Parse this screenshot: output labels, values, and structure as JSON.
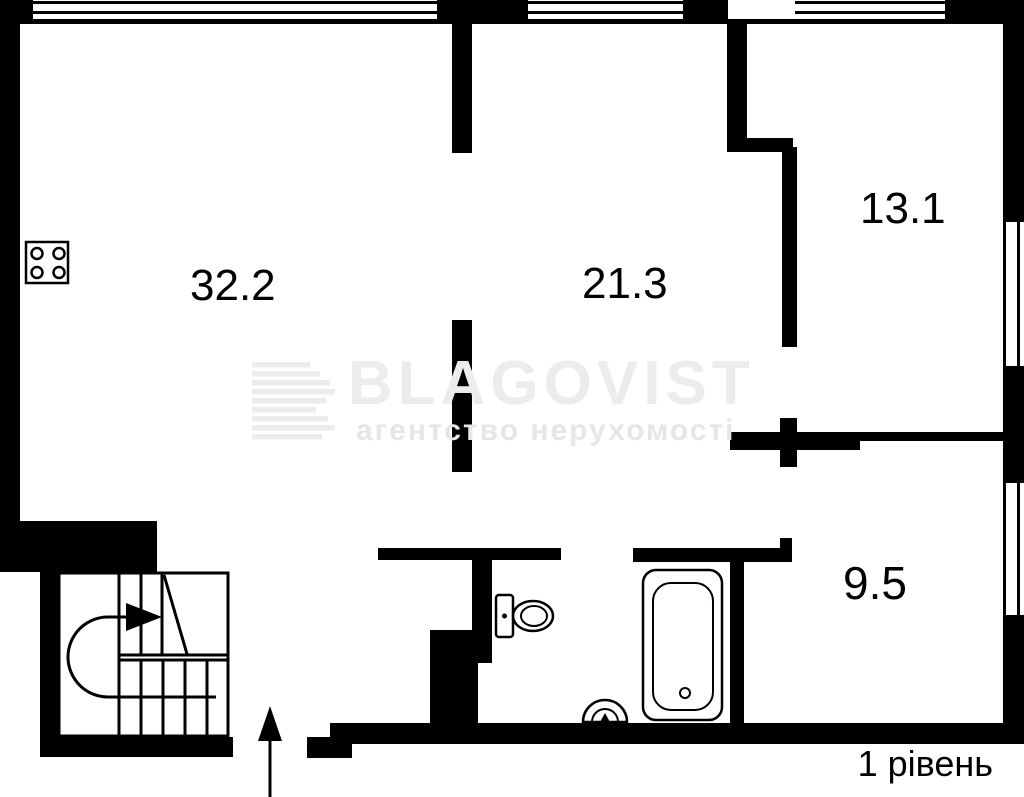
{
  "plan": {
    "level_label": "1 рівень",
    "rooms": [
      {
        "id": "living-kitchen",
        "area": "32.2"
      },
      {
        "id": "room-center",
        "area": "21.3"
      },
      {
        "id": "room-top-right",
        "area": "13.1"
      },
      {
        "id": "room-bottom-right",
        "area": "9.5"
      }
    ],
    "fixtures": [
      "stove-icon",
      "staircase",
      "stairs-direction-arrow",
      "entrance-arrow",
      "toilet-icon",
      "bathtub-icon",
      "sink-icon"
    ]
  },
  "watermark": {
    "brand": "BLAGOVIST",
    "subtitle": "агентство нерухомості"
  },
  "colors": {
    "wall": "#000000",
    "background": "#ffffff",
    "watermark_light": "#ececec",
    "watermark_subtitle": "#e6e6e6"
  }
}
